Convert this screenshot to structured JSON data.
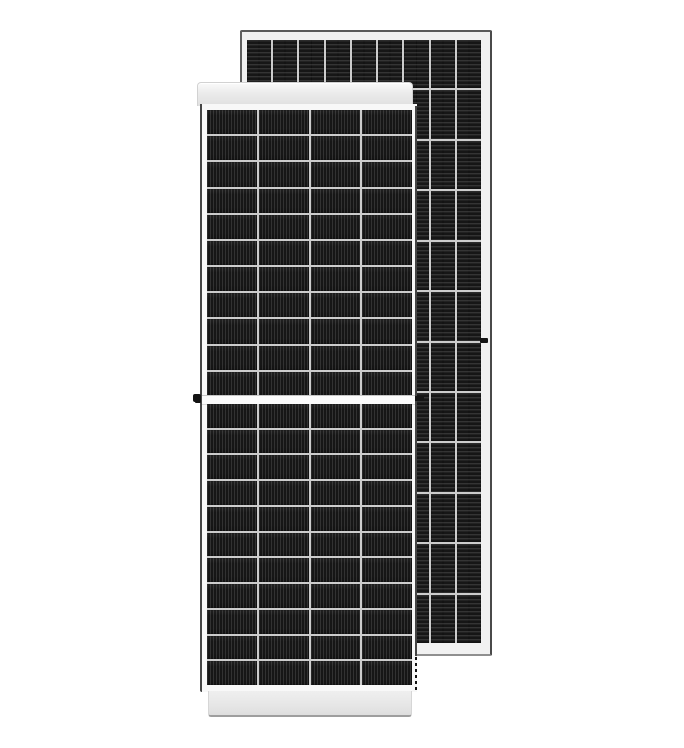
{
  "scene": {
    "description": "Product photo of two monocrystalline half-cut solar PV modules on a plain white background: a front-view panel with white aluminium frame overlapping a rear-view panel behind it to the upper right.",
    "background_color": "#ffffff",
    "visible_text": []
  },
  "colors": {
    "background": "#ffffff",
    "cell_dark": "#161616",
    "grid_line": "#cccccc",
    "frame_white": "#f8f8f8",
    "frame_light": "#f1f1f1",
    "frame_edge_dark": "#454545",
    "frame_edge_soft": "#9e9e9e",
    "mark_black": "#141414"
  },
  "back_panel": {
    "label": "rear-view-solar-panel",
    "view": "back",
    "rows": 12,
    "cols": 9,
    "cell_texture": "horizontal-busbar-stripes",
    "frame_color_hint": "#f1f1f1",
    "frame_joint_mark": "small dark joint mark on right frame edge at mid height"
  },
  "front_panel": {
    "label": "front-view-solar-panel",
    "view": "front",
    "halves": 2,
    "rows_per_half": 11,
    "cols": 4,
    "cell_texture": "vertical-finger-stripes",
    "center_divider": "white horizontal gap between upper and lower cell halves",
    "top_frame_cap": "light gray frame strip above glass",
    "bottom_frame_cap": "light gray frame strip below glass",
    "grounding_mark": "small black grounding screw dot on left frame edge at mid height"
  },
  "artifacts": {
    "gap_shadow_dash": "short dark dash where center divider meets right frame edge",
    "dashed_edge": "dashed remnant of right frame edge below rear panel corner"
  }
}
